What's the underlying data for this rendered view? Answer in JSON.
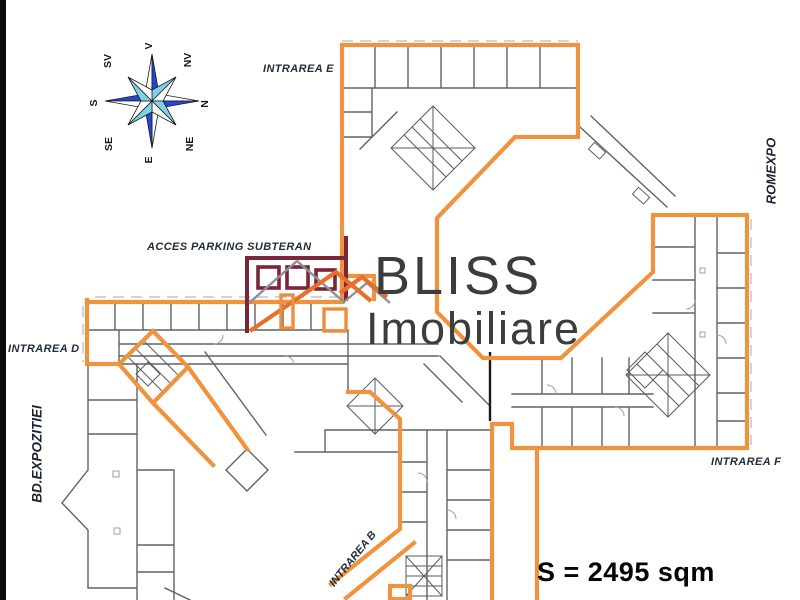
{
  "plan": {
    "labels": {
      "intrarea_e": "INTRAREA E",
      "intrarea_d": "INTRAREA D",
      "intrarea_f": "INTRAREA F",
      "intrarea_b": "INTRAREA B",
      "acces_parking": "ACCES PARKING SUBTERAN",
      "bd_expozitiei": "BD.EXPOZITIEI",
      "romexpo": "ROMEXPO",
      "area": "S = 2495 sqm"
    },
    "logo": {
      "line1": "BLISS",
      "line2": "Imobiliare"
    },
    "compass": {
      "points": [
        "V",
        "NV",
        "N",
        "NE",
        "E",
        "SE",
        "S",
        "SV"
      ]
    },
    "colors": {
      "unit_outline": "#F0933E",
      "wall_gray": "#5E6369",
      "logo_maroon": "#7B2537",
      "logo_roof_orange": "#E76F2E",
      "compass_blue": "#2746D0",
      "compass_cyan": "#7FD2E8",
      "label_text": "#242d3b"
    }
  }
}
